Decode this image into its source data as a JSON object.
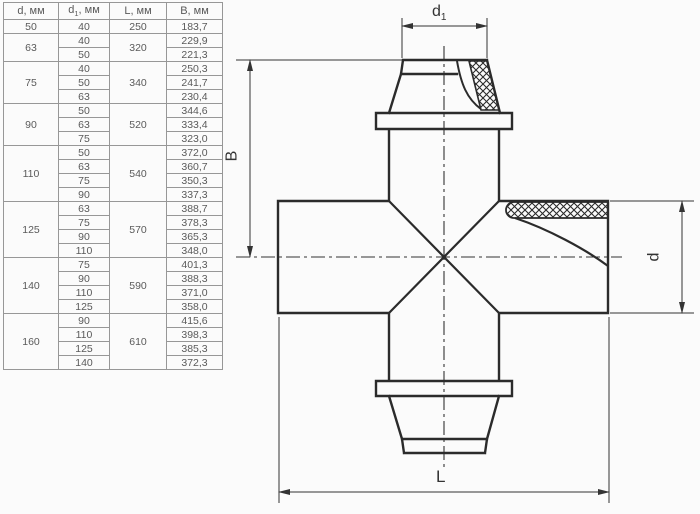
{
  "table": {
    "headers": [
      {
        "sym": "d",
        "sub": "",
        "unit": ", мм"
      },
      {
        "sym": "d",
        "sub": "1",
        "unit": ", мм"
      },
      {
        "sym": "L",
        "sub": "",
        "unit": ", мм"
      },
      {
        "sym": "B",
        "sub": "",
        "unit": ", мм"
      }
    ],
    "groups": [
      {
        "d": "50",
        "L": "250",
        "rows": [
          {
            "d1": "40",
            "B": "183,7"
          }
        ]
      },
      {
        "d": "63",
        "L": "320",
        "rows": [
          {
            "d1": "40",
            "B": "229,9"
          },
          {
            "d1": "50",
            "B": "221,3"
          }
        ]
      },
      {
        "d": "75",
        "L": "340",
        "rows": [
          {
            "d1": "40",
            "B": "250,3"
          },
          {
            "d1": "50",
            "B": "241,7"
          },
          {
            "d1": "63",
            "B": "230,4"
          }
        ]
      },
      {
        "d": "90",
        "L": "520",
        "rows": [
          {
            "d1": "50",
            "B": "344,6"
          },
          {
            "d1": "63",
            "B": "333,4"
          },
          {
            "d1": "75",
            "B": "323,0"
          }
        ]
      },
      {
        "d": "110",
        "L": "540",
        "rows": [
          {
            "d1": "50",
            "B": "372,0"
          },
          {
            "d1": "63",
            "B": "360,7"
          },
          {
            "d1": "75",
            "B": "350,3"
          },
          {
            "d1": "90",
            "B": "337,3"
          }
        ]
      },
      {
        "d": "125",
        "L": "570",
        "rows": [
          {
            "d1": "63",
            "B": "388,7"
          },
          {
            "d1": "75",
            "B": "378,3"
          },
          {
            "d1": "90",
            "B": "365,3"
          },
          {
            "d1": "110",
            "B": "348,0"
          }
        ]
      },
      {
        "d": "140",
        "L": "590",
        "rows": [
          {
            "d1": "75",
            "B": "401,3"
          },
          {
            "d1": "90",
            "B": "388,3"
          },
          {
            "d1": "110",
            "B": "371,0"
          },
          {
            "d1": "125",
            "B": "358,0"
          }
        ]
      },
      {
        "d": "160",
        "L": "610",
        "rows": [
          {
            "d1": "90",
            "B": "415,6"
          },
          {
            "d1": "110",
            "B": "398,3"
          },
          {
            "d1": "125",
            "B": "385,3"
          },
          {
            "d1": "140",
            "B": "372,3"
          }
        ]
      }
    ]
  },
  "drawing_labels": {
    "top_base": "d",
    "top_sub": "1",
    "left": "B",
    "right": "d",
    "bottom": "L"
  },
  "colors": {
    "outline": "#2b2b2b",
    "dimension": "#333333",
    "table_border": "#979797",
    "table_text": "#5a5a5a",
    "background": "#fbfbfb"
  }
}
